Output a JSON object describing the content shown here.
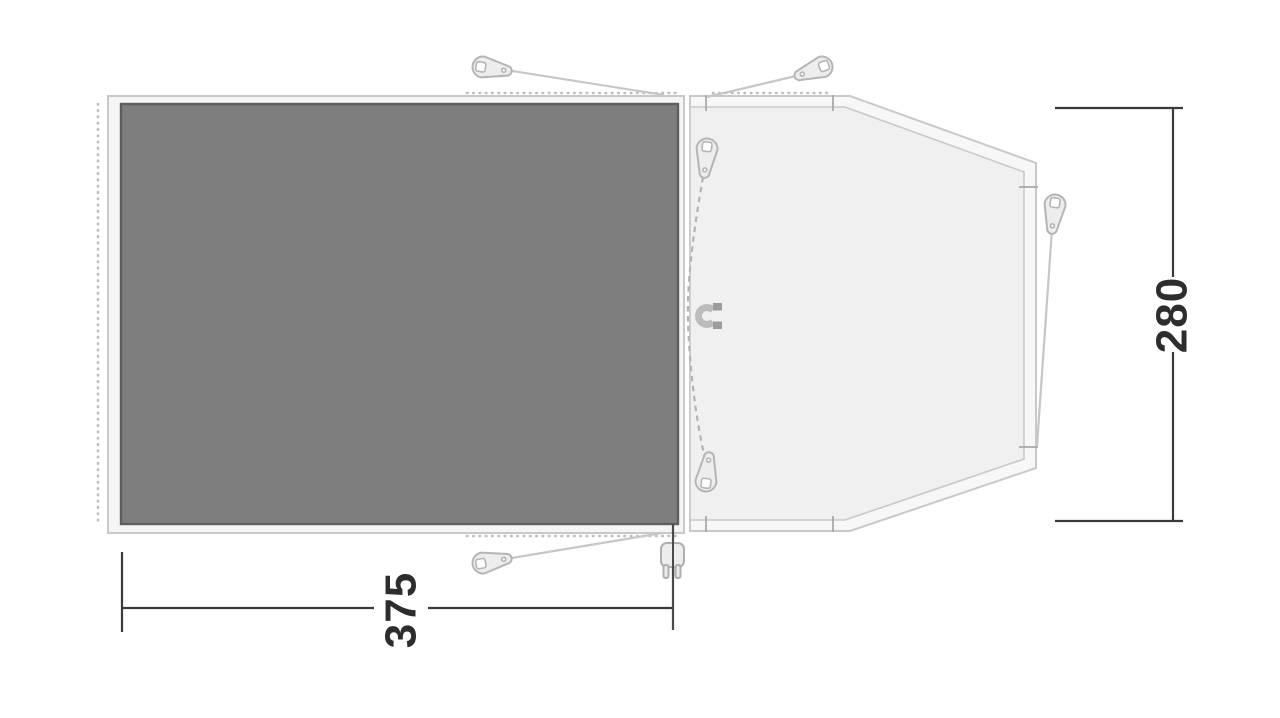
{
  "page": {
    "title": "Tent floor plan diagram",
    "background": "#ffffff"
  },
  "floorplan": {
    "dimensions": {
      "width": {
        "value": "375",
        "orientation": "horizontal-bottom"
      },
      "depth": {
        "value": "280",
        "orientation": "vertical-right"
      }
    },
    "areas": {
      "inner_tent_fill": "#7e7e7e",
      "groundsheet_fill": "#f5f5f5",
      "porch_outer_fill": "#f7f7f7",
      "porch_inner_fill": "#f0f0f0"
    },
    "colors": {
      "outline": "#c9c9c9",
      "accessory": "#c0c0c0",
      "dimension_line": "#3a3a3a",
      "dimension_text": "#2d2d2d",
      "magnet_body": "#bcbcbc",
      "magnet_tip": "#9c9c9c"
    },
    "icons": {
      "pegs": "tent-peg-icon",
      "magnet": "magnet-door-closure-icon",
      "plug": "power-cable-entry-icon"
    }
  }
}
